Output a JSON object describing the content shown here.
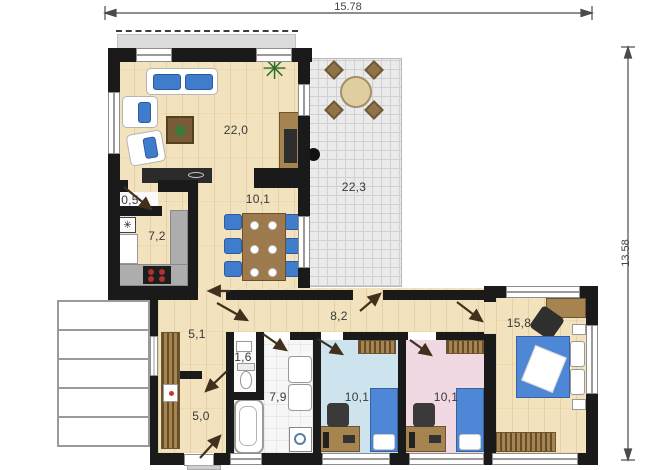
{
  "plan": {
    "dim_width": "15.78",
    "dim_height": "13.58",
    "rooms": {
      "living": {
        "label": "22,0"
      },
      "dining": {
        "label": "10,1"
      },
      "terrace": {
        "label": "22,3"
      },
      "closet": {
        "label": "0,5"
      },
      "kitchen": {
        "label": "7,2"
      },
      "hall": {
        "label": "5,1"
      },
      "corridor": {
        "label": "8,2"
      },
      "wc": {
        "label": "1,6"
      },
      "bathroom": {
        "label": "7,9"
      },
      "entry": {
        "label": "5,0"
      },
      "child_room_left": {
        "label": "10,1"
      },
      "child_room_right": {
        "label": "10,1"
      },
      "bedroom": {
        "label": "15,8"
      }
    },
    "icons": {
      "freezer": "✳",
      "plant": "✳"
    },
    "colors": {
      "wall": "#1a1a1a",
      "wood_floor": "#f2e2bd",
      "terrace_tile": "#eaeaea",
      "child_room_blue": "#cde4ee",
      "child_room_pink": "#f0d9e2",
      "furniture_blue": "#3f7ccb",
      "furniture_brown": "#a5844f",
      "door_arrow": "#42301c"
    }
  }
}
